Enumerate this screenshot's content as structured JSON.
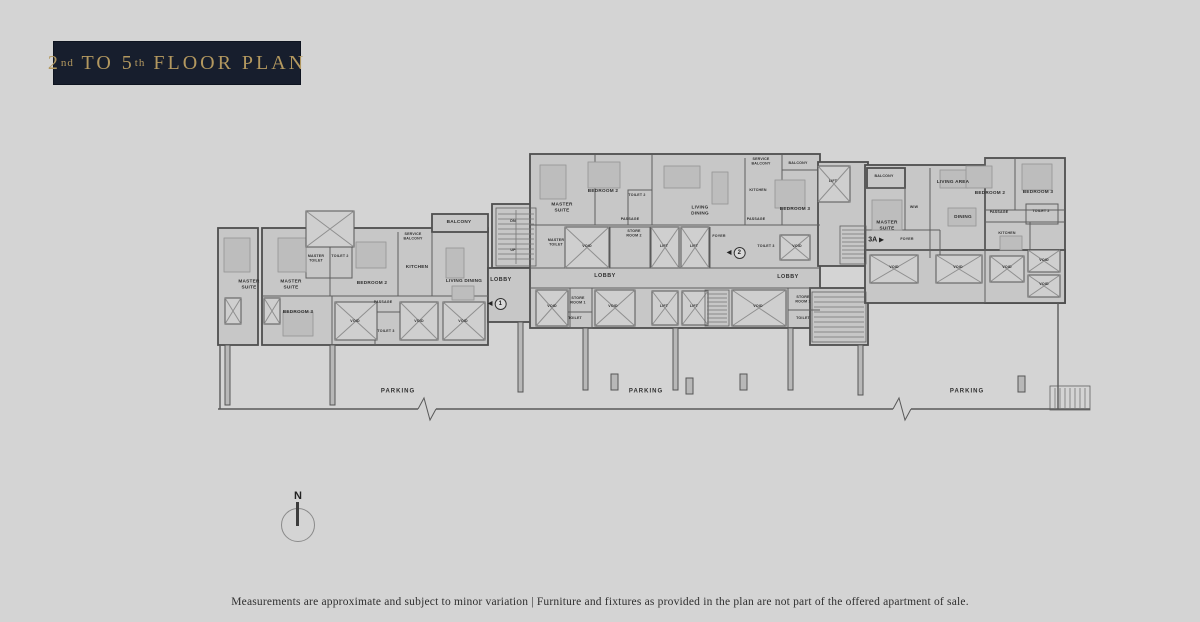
{
  "header": {
    "badge": {
      "n1": "2",
      "s1": "nd",
      "mid": " TO ",
      "n2": "5",
      "s2": "th",
      "rest": " FLOOR PLAN"
    }
  },
  "compass": {
    "label": "N"
  },
  "footer": {
    "disclaimer": "Measurements are approximate and subject to minor variation | Furniture and fixtures as provided in the plan are not part of the offered apartment of sale."
  },
  "colors": {
    "background": "#d4d4d4",
    "badge_bg": "#171e2d",
    "badge_gold": "#b3985f",
    "wall": "#4e4e4e",
    "room_fill": "#c7c7c7"
  },
  "plan": {
    "labels": [
      {
        "t": "MASTER\nSUITE",
        "x": 249,
        "y": 285
      },
      {
        "t": "MASTER\nSUITE",
        "x": 291,
        "y": 285
      },
      {
        "t": "MASTER\nTOILET",
        "x": 316,
        "y": 259,
        "s": "sm"
      },
      {
        "t": "TOILET 2",
        "x": 340,
        "y": 257,
        "s": "sm"
      },
      {
        "t": "BEDROOM 2",
        "x": 372,
        "y": 284
      },
      {
        "t": "KITCHEN",
        "x": 417,
        "y": 268
      },
      {
        "t": "LIVING DINING",
        "x": 464,
        "y": 282
      },
      {
        "t": "BALCONY",
        "x": 459,
        "y": 223
      },
      {
        "t": "SERVICE\nBALCONY",
        "x": 413,
        "y": 237,
        "s": "sm"
      },
      {
        "t": "BEDROOM 3",
        "x": 298,
        "y": 313
      },
      {
        "t": "PASSAGE",
        "x": 383,
        "y": 303,
        "s": "sm"
      },
      {
        "t": "TOILET 3",
        "x": 386,
        "y": 332,
        "s": "sm"
      },
      {
        "t": "VOID",
        "x": 355,
        "y": 322,
        "s": "sm"
      },
      {
        "t": "VOID",
        "x": 419,
        "y": 322,
        "s": "sm"
      },
      {
        "t": "VOID",
        "x": 463,
        "y": 322,
        "s": "sm"
      },
      {
        "t": "DN",
        "x": 513,
        "y": 222,
        "s": "sm"
      },
      {
        "t": "UP",
        "x": 513,
        "y": 251,
        "s": "sm"
      },
      {
        "t": "LOBBY",
        "x": 501,
        "y": 281,
        "s": "md"
      },
      {
        "t": "MASTER\nSUITE",
        "x": 562,
        "y": 208
      },
      {
        "t": "BEDROOM 2",
        "x": 603,
        "y": 192
      },
      {
        "t": "TOILET 2",
        "x": 637,
        "y": 196,
        "s": "sm"
      },
      {
        "t": "LIVING\nDINING",
        "x": 700,
        "y": 211
      },
      {
        "t": "PASSAGE",
        "x": 630,
        "y": 220,
        "s": "sm"
      },
      {
        "t": "MASTER\nTOILET",
        "x": 556,
        "y": 243,
        "s": "sm"
      },
      {
        "t": "VOID",
        "x": 587,
        "y": 247,
        "s": "sm"
      },
      {
        "t": "STORE\nROOM 2",
        "x": 634,
        "y": 234,
        "s": "sm"
      },
      {
        "t": "LIFT",
        "x": 664,
        "y": 247,
        "s": "sm"
      },
      {
        "t": "LIFT",
        "x": 694,
        "y": 247,
        "s": "sm"
      },
      {
        "t": "FOYER",
        "x": 719,
        "y": 237,
        "s": "sm"
      },
      {
        "t": "SERVICE\nBALCONY",
        "x": 761,
        "y": 162,
        "s": "sm"
      },
      {
        "t": "BALCONY",
        "x": 798,
        "y": 164,
        "s": "sm"
      },
      {
        "t": "KITCHEN",
        "x": 758,
        "y": 191,
        "s": "sm"
      },
      {
        "t": "BEDROOM 3",
        "x": 795,
        "y": 210
      },
      {
        "t": "PASSAGE",
        "x": 756,
        "y": 220,
        "s": "sm"
      },
      {
        "t": "LIFT",
        "x": 833,
        "y": 182,
        "s": "sm"
      },
      {
        "t": "TOILET 3",
        "x": 766,
        "y": 247,
        "s": "sm"
      },
      {
        "t": "VOID",
        "x": 797,
        "y": 247,
        "s": "sm"
      },
      {
        "t": "LOBBY",
        "x": 605,
        "y": 277,
        "s": "md"
      },
      {
        "t": "VOID",
        "x": 552,
        "y": 307,
        "s": "sm"
      },
      {
        "t": "STORE\nROOM 1",
        "x": 578,
        "y": 301,
        "s": "sm"
      },
      {
        "t": "TOILET",
        "x": 575,
        "y": 319,
        "s": "sm"
      },
      {
        "t": "VOID",
        "x": 613,
        "y": 307,
        "s": "sm"
      },
      {
        "t": "LIFT",
        "x": 664,
        "y": 307,
        "s": "sm"
      },
      {
        "t": "LIFT",
        "x": 694,
        "y": 307,
        "s": "sm"
      },
      {
        "t": "VOID",
        "x": 758,
        "y": 307,
        "s": "sm"
      },
      {
        "t": "LOBBY",
        "x": 788,
        "y": 278,
        "s": "md"
      },
      {
        "t": "STORE\nROOM 1",
        "x": 803,
        "y": 300,
        "s": "sm"
      },
      {
        "t": "TOILET",
        "x": 803,
        "y": 319,
        "s": "sm"
      },
      {
        "t": "BALCONY",
        "x": 884,
        "y": 177,
        "s": "sm"
      },
      {
        "t": "MASTER\nSUITE",
        "x": 887,
        "y": 226
      },
      {
        "t": "WIW",
        "x": 914,
        "y": 208,
        "s": "sm"
      },
      {
        "t": "LIVING AREA",
        "x": 953,
        "y": 183
      },
      {
        "t": "BEDROOM 2",
        "x": 990,
        "y": 194
      },
      {
        "t": "DINING",
        "x": 963,
        "y": 218
      },
      {
        "t": "FOYER",
        "x": 907,
        "y": 240,
        "s": "sm"
      },
      {
        "t": "BEDROOM 3",
        "x": 1038,
        "y": 193
      },
      {
        "t": "PASSAGE",
        "x": 999,
        "y": 213,
        "s": "sm"
      },
      {
        "t": "TOILET 2",
        "x": 1041,
        "y": 212,
        "s": "sm"
      },
      {
        "t": "KITCHEN",
        "x": 1007,
        "y": 234,
        "s": "sm"
      },
      {
        "t": "VOID",
        "x": 894,
        "y": 268,
        "s": "sm"
      },
      {
        "t": "VOID",
        "x": 958,
        "y": 268,
        "s": "sm"
      },
      {
        "t": "VOID",
        "x": 1007,
        "y": 268,
        "s": "sm"
      },
      {
        "t": "VOID",
        "x": 1044,
        "y": 261,
        "s": "sm"
      },
      {
        "t": "VOID",
        "x": 1044,
        "y": 285,
        "s": "sm"
      },
      {
        "t": "PARKING",
        "x": 398,
        "y": 392,
        "s": "lg"
      },
      {
        "t": "PARKING",
        "x": 646,
        "y": 392,
        "s": "lg"
      },
      {
        "t": "PARKING",
        "x": 967,
        "y": 392,
        "s": "lg"
      }
    ],
    "markers": [
      {
        "num": "1",
        "x": 497,
        "y": 304,
        "dir": "left"
      },
      {
        "num": "2",
        "x": 736,
        "y": 253,
        "dir": "left"
      },
      {
        "num": "3A",
        "x": 876,
        "y": 240,
        "dir": "right"
      }
    ]
  }
}
